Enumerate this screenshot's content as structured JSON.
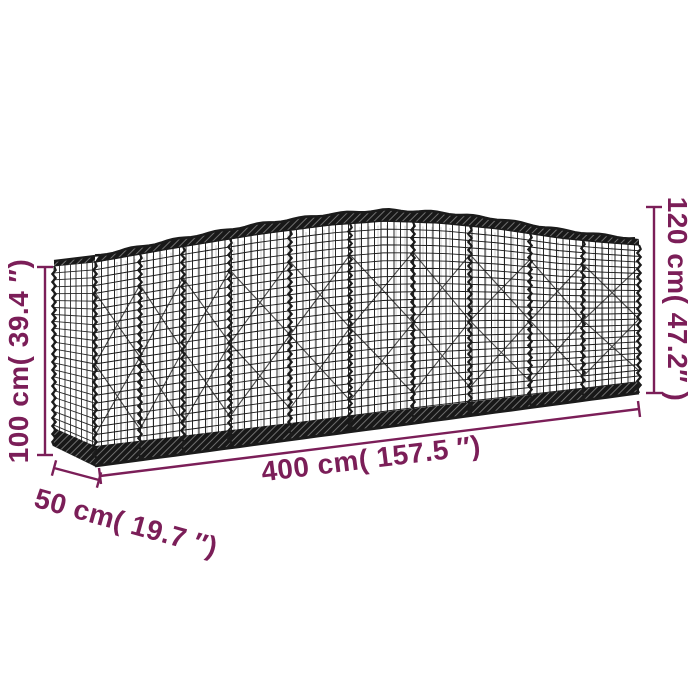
{
  "page": {
    "background": "#ffffff"
  },
  "diagram": {
    "type": "product-dimension-diagram",
    "subject": "arched-gabion-wire-mesh-basket",
    "units": [
      "cm",
      "inches"
    ]
  },
  "dimensions": {
    "length": {
      "label": "400 cm( 157.5 ″)",
      "cm": 400,
      "inches": 157.5
    },
    "depth": {
      "label": "50 cm( 19.7 ″)",
      "cm": 50,
      "inches": 19.7
    },
    "height_left": {
      "label": "100 cm( 39.4 ″)",
      "cm": 100,
      "inches": 39.4
    },
    "height_right": {
      "label": "120 cm( 47.2″ )",
      "cm": 120,
      "inches": 47.2
    }
  },
  "colors": {
    "dimension_annotation": "#7b1e58",
    "wire": "#1b1b1b",
    "background": "#ffffff"
  }
}
